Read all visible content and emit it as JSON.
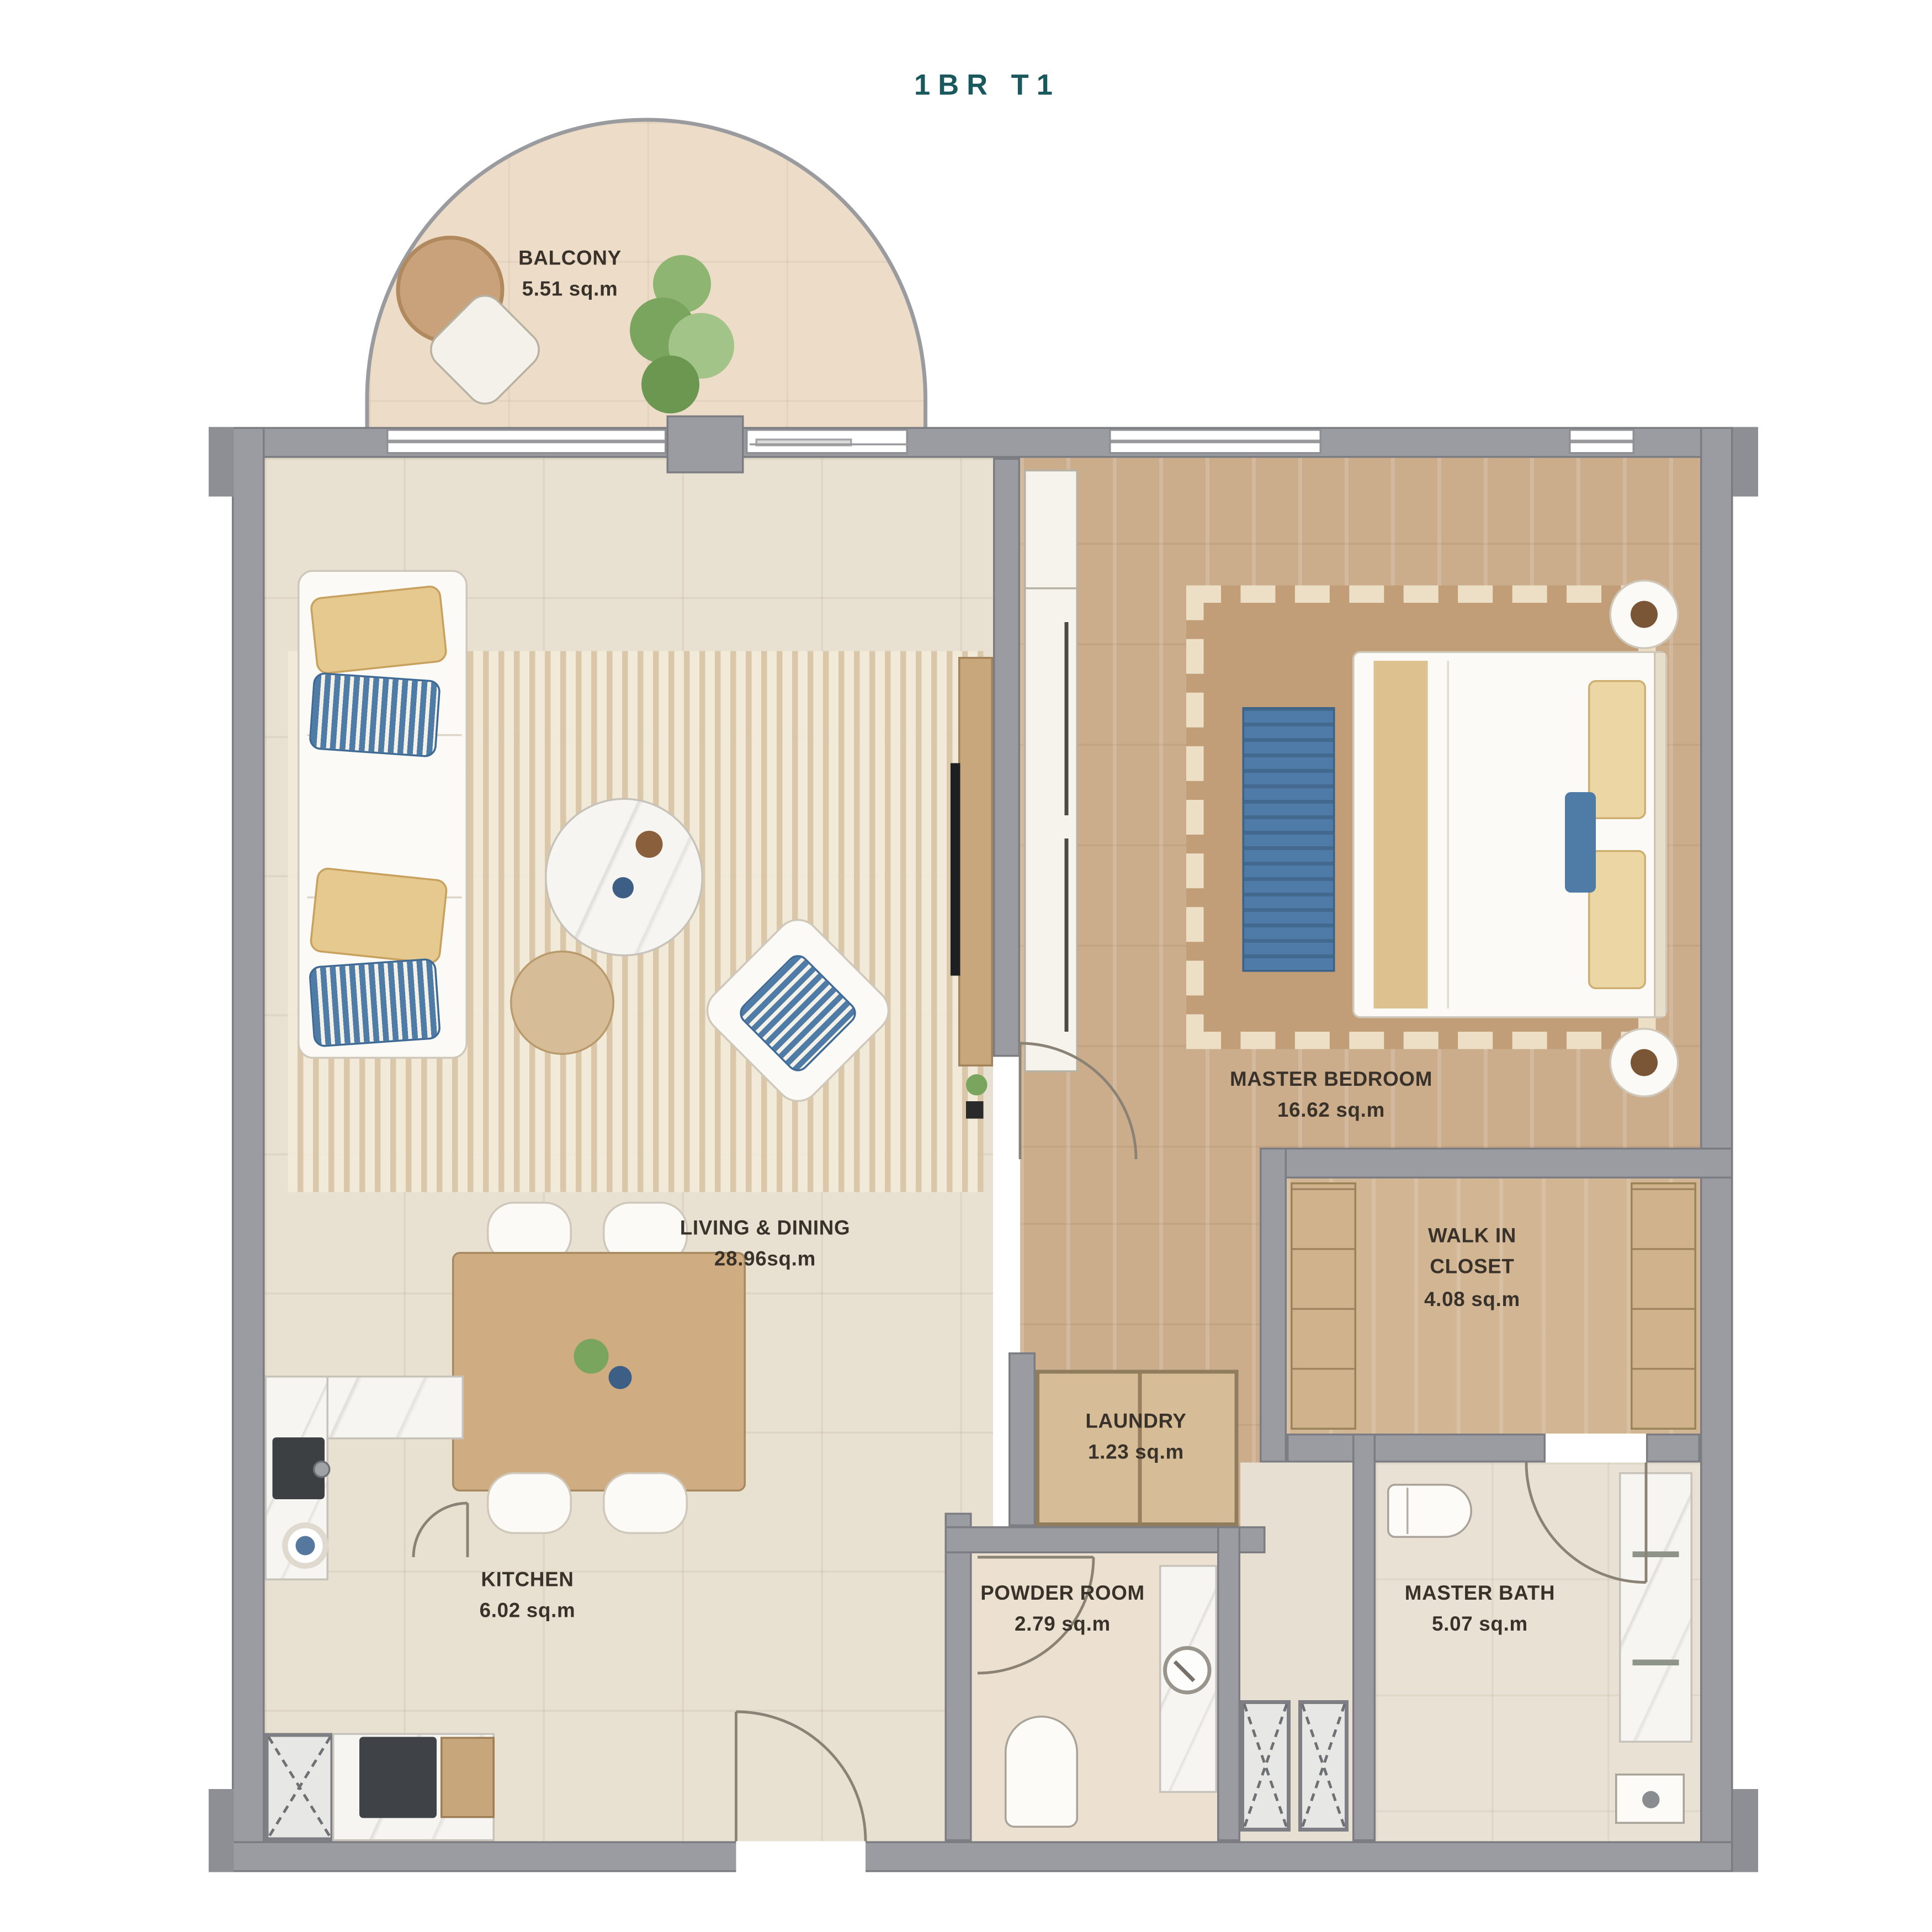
{
  "title": "1BR T1",
  "plan_type": "apartment floor plan",
  "colors": {
    "title_teal": "#19585C",
    "wall_gray": "#9B9CA1",
    "floor_beige": "#E8E0D1",
    "balcony_beige": "#EDDCC8",
    "wood_floor": "#CBAD8C",
    "accent_blue": "#4E7CA6",
    "accent_yellow": "#E5C98F",
    "marble_white": "#F6F5F1"
  },
  "rooms": [
    {
      "id": "balcony",
      "name": "BALCONY",
      "area": "5.51 sq.m"
    },
    {
      "id": "living-dining",
      "name": "LIVING & DINING",
      "area": "28.96sq.m"
    },
    {
      "id": "master-bedroom",
      "name": "MASTER BEDROOM",
      "area": "16.62 sq.m"
    },
    {
      "id": "walk-in-closet",
      "name": "WALK IN CLOSET",
      "area": "4.08 sq.m"
    },
    {
      "id": "laundry",
      "name": "LAUNDRY",
      "area": "1.23 sq.m"
    },
    {
      "id": "kitchen",
      "name": "KITCHEN",
      "area": "6.02 sq.m"
    },
    {
      "id": "powder-room",
      "name": "POWDER ROOM",
      "area": "2.79 sq.m"
    },
    {
      "id": "master-bath",
      "name": "MASTER BATH",
      "area": "5.07 sq.m"
    }
  ]
}
